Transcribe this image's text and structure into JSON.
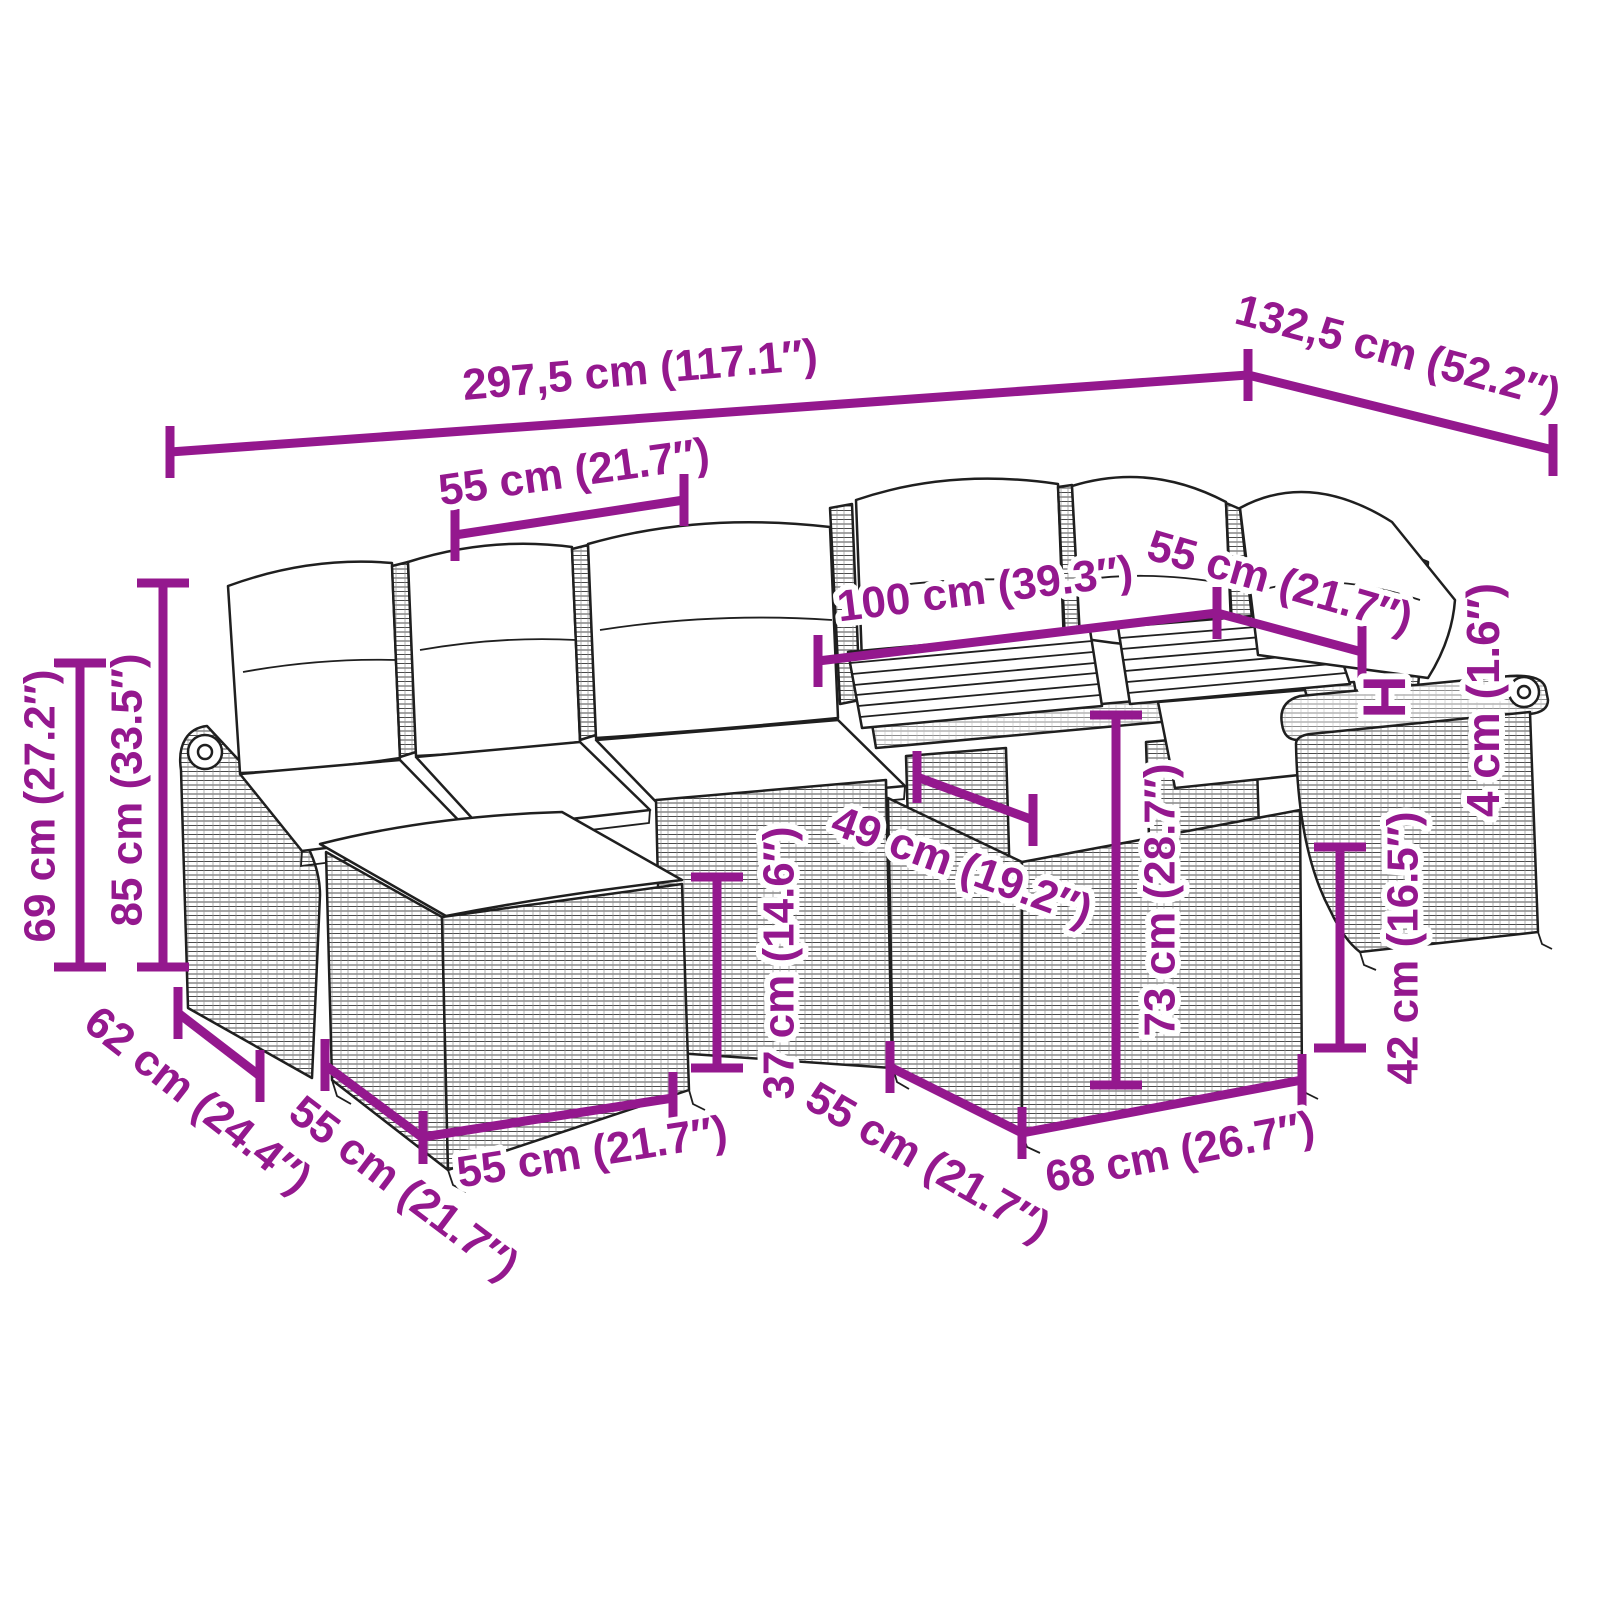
{
  "canvas": {
    "width": 1600,
    "height": 1600,
    "background": "#ffffff"
  },
  "accent_color": "#94188E",
  "line_width": 9,
  "tick_half_length": 26,
  "subject": "garden-furniture-set-dimension-diagram",
  "dimensions": [
    {
      "name": "total-width",
      "label": "297,5 cm (117.1″)",
      "x1": 170,
      "y1": 452,
      "x2": 1248,
      "y2": 375,
      "ticks": "v",
      "label_x": 640,
      "label_y": 370,
      "label_rotation": -5
    },
    {
      "name": "total-depth-right",
      "label": "132,5 cm (52.2″)",
      "x1": 1248,
      "y1": 375,
      "x2": 1553,
      "y2": 450,
      "ticks": "v",
      "label_x": 1398,
      "label_y": 352,
      "label_rotation": 15
    },
    {
      "name": "seat-width-top",
      "label": "55 cm (21.7″)",
      "x1": 455,
      "y1": 535,
      "x2": 684,
      "y2": 500,
      "ticks": "v",
      "label_x": 574,
      "label_y": 472,
      "label_rotation": -8
    },
    {
      "name": "table-length",
      "label": "100 cm (39.3″)",
      "x1": 818,
      "y1": 661,
      "x2": 1217,
      "y2": 613,
      "ticks": "v",
      "label_x": 985,
      "label_y": 589,
      "label_rotation": -7
    },
    {
      "name": "seat-width-right",
      "label": "55 cm (21.7″)",
      "x1": 1217,
      "y1": 613,
      "x2": 1362,
      "y2": 652,
      "ticks": "v",
      "label_x": 1280,
      "label_y": 582,
      "label_rotation": 16
    },
    {
      "name": "table-top-side",
      "label": "49 cm (19.2″)",
      "x1": 917,
      "y1": 777,
      "x2": 1033,
      "y2": 820,
      "ticks": "v",
      "label_x": 962,
      "label_y": 866,
      "label_rotation": 20
    },
    {
      "name": "table-height",
      "label": "73 cm (28.7″)",
      "x1": 1116,
      "y1": 715,
      "x2": 1116,
      "y2": 1085,
      "ticks": "h",
      "label_x": 1160,
      "label_y": 900,
      "label_rotation": -90
    },
    {
      "name": "seat-height",
      "label": "37 cm (14.6″)",
      "x1": 717,
      "y1": 877,
      "x2": 717,
      "y2": 1068,
      "ticks": "h",
      "label_x": 779,
      "label_y": 963,
      "label_rotation": -90
    },
    {
      "name": "stool-height",
      "label": "42 cm (16.5″)",
      "x1": 1340,
      "y1": 847,
      "x2": 1340,
      "y2": 1048,
      "ticks": "h",
      "label_x": 1403,
      "label_y": 948,
      "label_rotation": -90
    },
    {
      "name": "table-width-front",
      "label": "68 cm (26.7″)",
      "x1": 1022,
      "y1": 1133,
      "x2": 1302,
      "y2": 1080,
      "ticks": "v",
      "label_x": 1180,
      "label_y": 1152,
      "label_rotation": -11
    },
    {
      "name": "sofa-depth",
      "label": "62 cm (24.4″)",
      "x1": 178,
      "y1": 1013,
      "x2": 260,
      "y2": 1076,
      "ticks": "v",
      "label_x": 198,
      "label_y": 1100,
      "label_rotation": 38
    },
    {
      "name": "stool-depth",
      "label": "55 cm (21.7″)",
      "x1": 325,
      "y1": 1065,
      "x2": 423,
      "y2": 1138,
      "ticks": "v",
      "label_x": 404,
      "label_y": 1188,
      "label_rotation": 37
    },
    {
      "name": "stool-width",
      "label": "55 cm (21.7″)",
      "x1": 423,
      "y1": 1137,
      "x2": 673,
      "y2": 1098,
      "ticks": "v",
      "label_x": 592,
      "label_y": 1152,
      "label_rotation": -9
    },
    {
      "name": "table-depth-side",
      "label": "55 cm (21.7″)",
      "x1": 890,
      "y1": 1067,
      "x2": 1022,
      "y2": 1133,
      "ticks": "v",
      "label_x": 928,
      "label_y": 1162,
      "label_rotation": 30
    },
    {
      "name": "back-height",
      "label": "85 cm (33.5″)",
      "x1": 163,
      "y1": 583,
      "x2": 163,
      "y2": 967,
      "ticks": "h",
      "label_x": 127,
      "label_y": 790,
      "label_rotation": -90
    },
    {
      "name": "arm-height",
      "label": "69 cm (27.2″)",
      "x1": 80,
      "y1": 663,
      "x2": 80,
      "y2": 967,
      "ticks": "h",
      "label_x": 40,
      "label_y": 806,
      "label_rotation": -90
    }
  ],
  "labels": [
    {
      "name": "height-reference",
      "text": "H",
      "x": 1384,
      "y": 697,
      "rotation": 90,
      "size": 60
    },
    {
      "name": "armrest-thickness",
      "text": "4 cm (1.6″)",
      "x": 1483,
      "y": 700,
      "rotation": -90,
      "size": 46
    }
  ]
}
